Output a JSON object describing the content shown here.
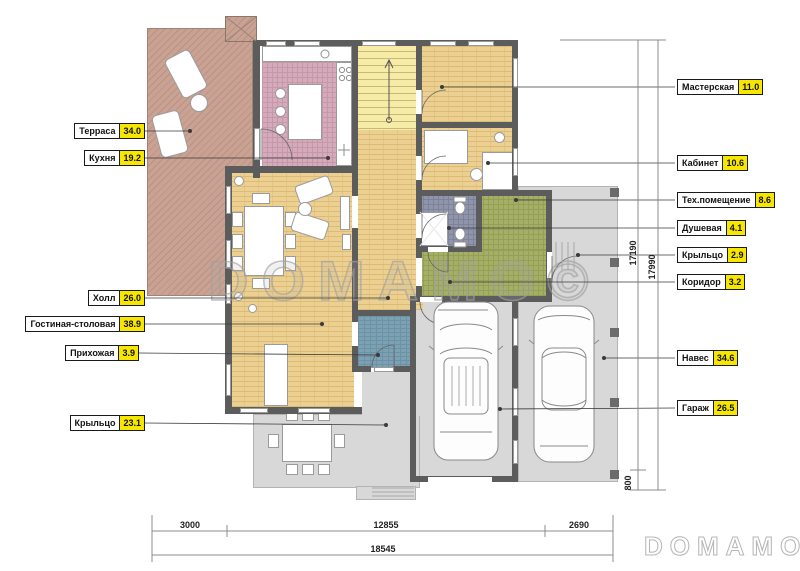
{
  "watermark": {
    "center_text": "DOMAMO©",
    "logo_text": "DOMAMO"
  },
  "callouts": {
    "left": [
      {
        "name": "Терраса",
        "value": "34.0"
      },
      {
        "name": "Кухня",
        "value": "19.2"
      },
      {
        "name": "Холл",
        "value": "26.0"
      },
      {
        "name": "Гостиная-столовая",
        "value": "38.9"
      },
      {
        "name": "Прихожая",
        "value": "3.9"
      },
      {
        "name": "Крыльцо",
        "value": "23.1"
      }
    ],
    "right": [
      {
        "name": "Мастерская",
        "value": "11.0"
      },
      {
        "name": "Кабинет",
        "value": "10.6"
      },
      {
        "name": "Тех.помещение",
        "value": "8.6"
      },
      {
        "name": "Душевая",
        "value": "4.1"
      },
      {
        "name": "Крыльцо",
        "value": "2.9"
      },
      {
        "name": "Коридор",
        "value": "3.2"
      },
      {
        "name": "Навес",
        "value": "34.6"
      },
      {
        "name": "Гараж",
        "value": "26.5"
      }
    ]
  },
  "dimensions": {
    "vertical": [
      {
        "value": "17190"
      },
      {
        "value": "17990"
      },
      {
        "value": "800"
      }
    ],
    "bottom_segments": [
      {
        "value": "3000"
      },
      {
        "value": "12855"
      },
      {
        "value": "2690"
      }
    ],
    "bottom_total": {
      "value": "18545"
    }
  },
  "colors": {
    "highlight_yellow": "#f6e600",
    "wall": "#5c5c5c",
    "terrace_floor": "#c9a294",
    "kitchen_floor": "#d5aaba",
    "parquet_floor": "#ebd092",
    "stairs_floor": "#f7eba8",
    "shower_floor": "#9095ac",
    "utility_floor": "#a5af67",
    "entry_floor": "#7ca1b3",
    "concrete_gray": "#d8d8d8"
  }
}
